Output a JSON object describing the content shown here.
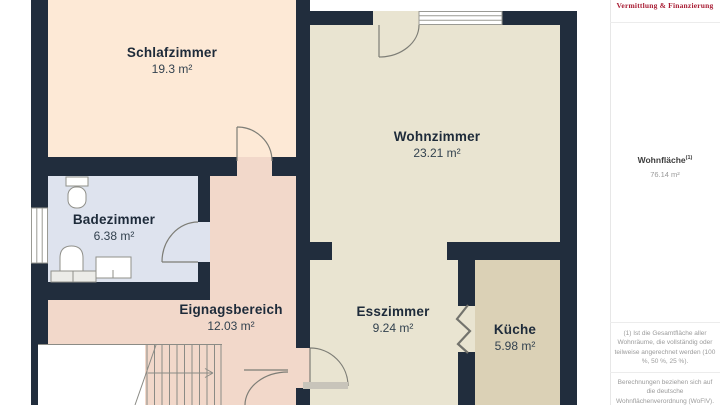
{
  "floorplan": {
    "wall_color": "#212d3d",
    "rooms": [
      {
        "id": "schlafzimmer",
        "name": "Schlafzimmer",
        "area": "19.3 m²",
        "fill": "#fde9d6"
      },
      {
        "id": "wohnzimmer",
        "name": "Wohnzimmer",
        "area": "23.21 m²",
        "fill": "#e9e4d1"
      },
      {
        "id": "badezimmer",
        "name": "Badezimmer",
        "area": "6.38 m²",
        "fill": "#dee3ee"
      },
      {
        "id": "eingangsbereich",
        "name": "Eignagsbereich",
        "area": "12.03 m²",
        "fill": "#f2d8ca"
      },
      {
        "id": "esszimmer",
        "name": "Esszimmer",
        "area": "9.24 m²",
        "fill": "#e9e4d1"
      },
      {
        "id": "kueche",
        "name": "Küche",
        "area": "5.98 m²",
        "fill": "#dbd1b6"
      }
    ]
  },
  "sidebar": {
    "logo_text": "Vermittlung & Finanzierung",
    "logo_color": "#a81c33",
    "total_label": "Wohnfläche",
    "total_superscript": "(1)",
    "total_value": "76.14 m²",
    "footnote_1": "(1) Ist die Gesamtfläche aller Wohnräume, die vollständig oder teilweise angerechnet werden (100 %, 50 %, 25 %).",
    "footnote_2": "Berechnungen beziehen sich auf die deutsche Wohnflächenverordnung (WoFlV). Maße sind ungefähre Angaben"
  }
}
